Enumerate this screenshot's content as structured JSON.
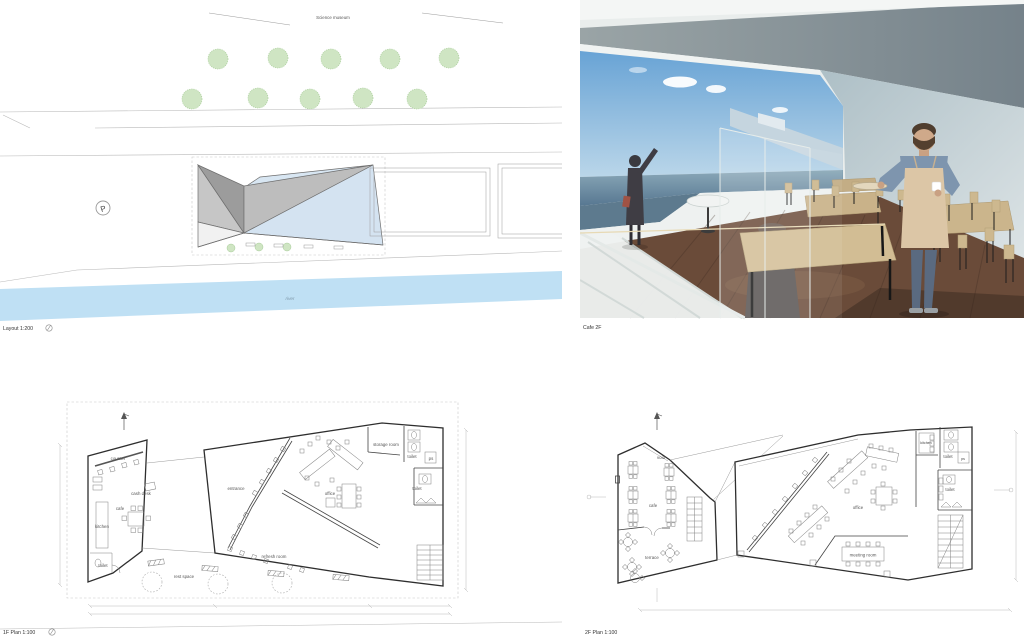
{
  "site_plan": {
    "caption": "Layout 1:200",
    "museum_label": "Science museum",
    "river_label": "river",
    "parking_label": "P"
  },
  "render": {
    "caption": "Cafe 2F"
  },
  "plan_1f": {
    "caption": "1F Plan 1:100",
    "rooms": {
      "counter": "counter",
      "cash_desk": "cash desk",
      "cafe": "cafe",
      "kitchen": "kitchen",
      "toilet_a": "toilet",
      "entrance": "entrance",
      "office": "office",
      "storage_room": "storage room",
      "toilet_b": "toilet",
      "ps": "ps",
      "toilet_c": "toilet",
      "refresh_room": "refresh room",
      "rest_space": "rest space"
    }
  },
  "plan_2f": {
    "caption": "2F Plan 1:100",
    "rooms": {
      "void_a": "void",
      "cafe": "cafe",
      "terrace": "terrace",
      "void_b": "void",
      "office": "office",
      "meeting_room": "meeting room",
      "kitchen": "kitchen",
      "toilet_a": "toilet",
      "ps": "ps",
      "toilet_b": "toilet"
    }
  }
}
